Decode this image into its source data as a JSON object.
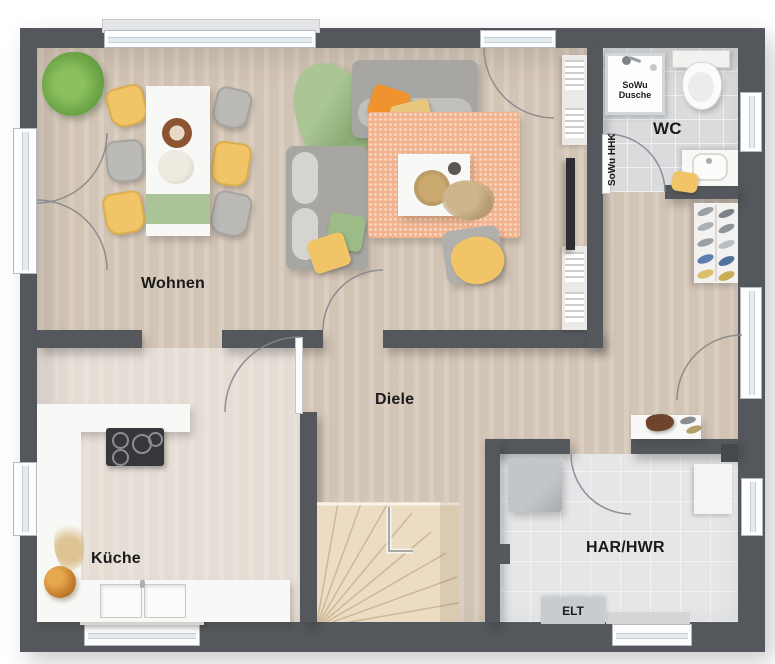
{
  "plan_title": "Ground floor plan",
  "rooms": {
    "wohnen": {
      "label": "Wohnen"
    },
    "diele": {
      "label": "Diele"
    },
    "kueche": {
      "label": "Küche"
    },
    "har_hwr": {
      "label": "HAR/HWR"
    },
    "wc": {
      "label": "WC"
    }
  },
  "fixtures": {
    "shower": {
      "label": "SoWu Dusche"
    },
    "heater": {
      "label": "SoWu HHK"
    },
    "electrical": {
      "label": "ELT"
    }
  },
  "colors": {
    "wall": "#54585c",
    "floor": "#d6c8b9",
    "floor-light": "#e9e0d6",
    "tile": "#d9dbdd",
    "tile-light": "#e4e6e8",
    "stair-wood": "#ecdcc2",
    "white-furn": "#f8f8f6",
    "sofa": "#a8a6a2",
    "rug": "#f2b48e",
    "green": "#9cbb87",
    "orange": "#f0922e",
    "yellow": "#f1c567",
    "ink": "#1a1a1a"
  }
}
